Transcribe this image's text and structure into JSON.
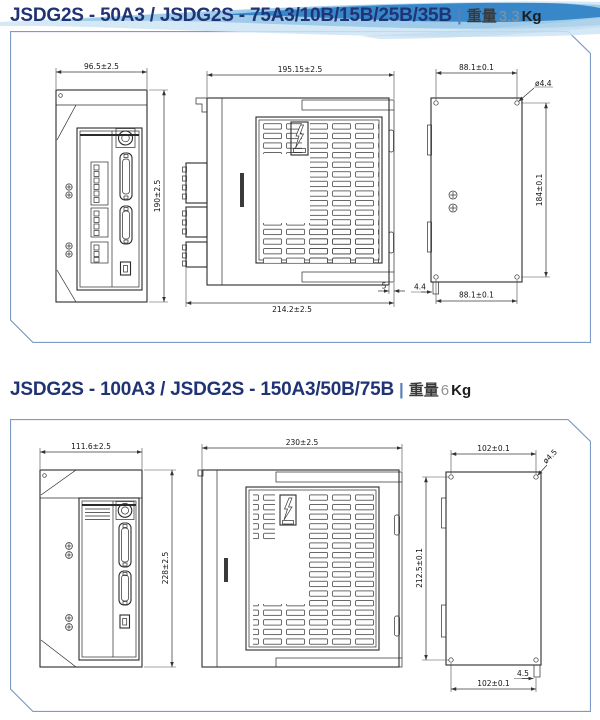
{
  "page": {
    "colors": {
      "title_navy": "#203374",
      "wave_blue": "#2e7fc4",
      "box_border": "#7d9bc7",
      "weight_gray": "#8f9296"
    }
  },
  "sections": [
    {
      "title": "JSDG2S - 50A3 / JSDG2S - 75A3/10B/15B/25B/35B",
      "divider": "|",
      "weight_label": "重量",
      "weight_value": "3.3",
      "weight_unit": "Kg",
      "dims": {
        "front_width": "96.5±2.5",
        "front_height": "190±2.5",
        "side_width": "195.15±2.5",
        "side_overall_width": "214.2±2.5",
        "side_tab_offset": "5",
        "back_hole_pitch_width_top": "88.1±0.1",
        "back_hole_dia": "ø4.4",
        "back_hole_pitch_height": "184±0.1",
        "back_tab_offset": "4.4",
        "back_hole_pitch_width_bottom": "88.1±0.1"
      }
    },
    {
      "title": "JSDG2S - 100A3 / JSDG2S - 150A3/50B/75B",
      "divider": "|",
      "weight_label": "重量",
      "weight_value": "6",
      "weight_unit": "Kg",
      "dims": {
        "front_width": "111.6±2.5",
        "front_height": "228±2.5",
        "side_width": "230±2.5",
        "back_hole_pitch_width_top": "102±0.1",
        "back_hole_dia": "ø4.5",
        "back_hole_pitch_height": "212.5±0.1",
        "back_tab_offset": "4.5",
        "back_hole_pitch_width_bottom": "102±0.1"
      }
    }
  ]
}
